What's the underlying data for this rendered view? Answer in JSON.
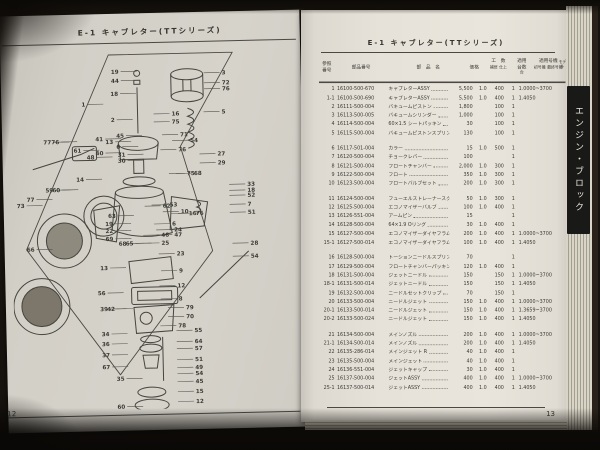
{
  "photo": {
    "background": "#17130e",
    "ink": "#3b3a35",
    "tab_bg": "#191917",
    "tab_fg": "#e9e6dd"
  },
  "left_page": {
    "header": "E-1 キャブレター(TTシリーズ)",
    "page_number": "12",
    "diagram_callouts": [
      {
        "n": "19",
        "x": 110,
        "y": 26
      },
      {
        "n": "44",
        "x": 110,
        "y": 35
      },
      {
        "n": "18",
        "x": 109,
        "y": 48
      },
      {
        "n": "3",
        "x": 213,
        "y": 29
      },
      {
        "n": "72",
        "x": 213,
        "y": 39
      },
      {
        "n": "76",
        "x": 213,
        "y": 45
      },
      {
        "n": "5",
        "x": 212,
        "y": 68
      },
      {
        "n": "1",
        "x": 76,
        "y": 58
      },
      {
        "n": "2",
        "x": 105,
        "y": 74
      },
      {
        "n": "16",
        "x": 162,
        "y": 69
      },
      {
        "n": "75",
        "x": 162,
        "y": 77
      },
      {
        "n": "45",
        "x": 114,
        "y": 90
      },
      {
        "n": "41",
        "x": 93,
        "y": 93
      },
      {
        "n": "13",
        "x": 103,
        "y": 96
      },
      {
        "n": "6",
        "x": 110,
        "y": 101
      },
      {
        "n": "40",
        "x": 93,
        "y": 107
      },
      {
        "n": "54",
        "x": 180,
        "y": 96
      },
      {
        "n": "71",
        "x": 170,
        "y": 90
      },
      {
        "n": "76",
        "x": 168,
        "y": 105
      },
      {
        "n": "31",
        "x": 115,
        "y": 109
      },
      {
        "n": "30",
        "x": 115,
        "y": 115
      },
      {
        "n": "77",
        "x": 41,
        "y": 95
      },
      {
        "n": "76",
        "x": 49,
        "y": 95
      },
      {
        "n": "61",
        "x": 71,
        "y": 104
      },
      {
        "n": "48",
        "x": 84,
        "y": 111
      },
      {
        "n": "27",
        "x": 207,
        "y": 110
      },
      {
        "n": "29",
        "x": 207,
        "y": 119
      },
      {
        "n": "14",
        "x": 73,
        "y": 133
      },
      {
        "n": "59",
        "x": 42,
        "y": 143
      },
      {
        "n": "60",
        "x": 49,
        "y": 143
      },
      {
        "n": "77",
        "x": 23,
        "y": 152
      },
      {
        "n": "73",
        "x": 13,
        "y": 158
      },
      {
        "n": "75",
        "x": 176,
        "y": 129
      },
      {
        "n": "68",
        "x": 183,
        "y": 129
      },
      {
        "n": "33",
        "x": 236,
        "y": 141
      },
      {
        "n": "18",
        "x": 236,
        "y": 147
      },
      {
        "n": "52",
        "x": 236,
        "y": 152
      },
      {
        "n": "7",
        "x": 236,
        "y": 161
      },
      {
        "n": "51",
        "x": 236,
        "y": 169
      },
      {
        "n": "62",
        "x": 151,
        "y": 161
      },
      {
        "n": "53",
        "x": 158,
        "y": 160
      },
      {
        "n": "10",
        "x": 169,
        "y": 167
      },
      {
        "n": "16",
        "x": 177,
        "y": 169
      },
      {
        "n": "76",
        "x": 184,
        "y": 169
      },
      {
        "n": "63",
        "x": 104,
        "y": 170
      },
      {
        "n": "19",
        "x": 101,
        "y": 178
      },
      {
        "n": "22",
        "x": 101,
        "y": 185
      },
      {
        "n": "69",
        "x": 101,
        "y": 193
      },
      {
        "n": "6",
        "x": 160,
        "y": 179
      },
      {
        "n": "24",
        "x": 162,
        "y": 185
      },
      {
        "n": "47",
        "x": 162,
        "y": 190
      },
      {
        "n": "46",
        "x": 149,
        "y": 190
      },
      {
        "n": "25",
        "x": 149,
        "y": 198
      },
      {
        "n": "68",
        "x": 114,
        "y": 198
      },
      {
        "n": "65",
        "x": 121,
        "y": 198
      },
      {
        "n": "23",
        "x": 164,
        "y": 209
      },
      {
        "n": "66",
        "x": 22,
        "y": 202
      },
      {
        "n": "13",
        "x": 95,
        "y": 222
      },
      {
        "n": "9",
        "x": 166,
        "y": 226
      },
      {
        "n": "12",
        "x": 164,
        "y": 241
      },
      {
        "n": "56",
        "x": 92,
        "y": 247
      },
      {
        "n": "39",
        "x": 94,
        "y": 263
      },
      {
        "n": "42",
        "x": 101,
        "y": 263
      },
      {
        "n": "8",
        "x": 165,
        "y": 254
      },
      {
        "n": "79",
        "x": 172,
        "y": 263
      },
      {
        "n": "70",
        "x": 172,
        "y": 272
      },
      {
        "n": "78",
        "x": 164,
        "y": 281
      },
      {
        "n": "28",
        "x": 238,
        "y": 200
      },
      {
        "n": "54",
        "x": 238,
        "y": 213
      },
      {
        "n": "34",
        "x": 95,
        "y": 288
      },
      {
        "n": "55",
        "x": 180,
        "y": 286
      },
      {
        "n": "64",
        "x": 180,
        "y": 297
      },
      {
        "n": "57",
        "x": 180,
        "y": 304
      },
      {
        "n": "36",
        "x": 95,
        "y": 298
      },
      {
        "n": "37",
        "x": 95,
        "y": 309
      },
      {
        "n": "67",
        "x": 95,
        "y": 321
      },
      {
        "n": "51",
        "x": 180,
        "y": 315
      },
      {
        "n": "49",
        "x": 180,
        "y": 323
      },
      {
        "n": "54",
        "x": 180,
        "y": 329
      },
      {
        "n": "35",
        "x": 109,
        "y": 333
      },
      {
        "n": "45",
        "x": 180,
        "y": 337
      },
      {
        "n": "15",
        "x": 180,
        "y": 347
      },
      {
        "n": "12",
        "x": 180,
        "y": 357
      },
      {
        "n": "60",
        "x": 109,
        "y": 361
      }
    ]
  },
  "right_page": {
    "header": "E-1 キャブレター(TTシリーズ)",
    "page_number": "13",
    "side_tab": "エンジン・ブロック",
    "table": {
      "headers": {
        "ref_l1": "参照",
        "ref_l2": "番号",
        "part": "部品番号",
        "name": "部　品　名",
        "price": "価格",
        "labor": "工　数",
        "labor_s1": "補修",
        "labor_s2": "仕上",
        "apply_l1": "適用",
        "apply_l2": "台数",
        "apply_s": "台",
        "serial": "適用号機",
        "serial_s1": "初号機",
        "serial_s2": "最終号機",
        "model": "モデル"
      },
      "rows": [
        {
          "ref": "1",
          "part": "16100-500-670",
          "name": "キャブレターASSY",
          "price": "5,500",
          "labor": "1.0",
          "apply": "400",
          "qty": "1",
          "serial": "1.0000~3700",
          "gap": false
        },
        {
          "ref": "1-1",
          "part": "16100-500-690",
          "name": "キャブレターASSY",
          "price": "5,500",
          "labor": "1.0",
          "apply": "400",
          "qty": "1",
          "serial": "1.4050",
          "gap": false
        },
        {
          "ref": "2",
          "part": "16111-500-004",
          "name": "バキュームピストン",
          "price": "1,800",
          "labor": "",
          "apply": "100",
          "qty": "1",
          "serial": "",
          "gap": false
        },
        {
          "ref": "3",
          "part": "16113-500-005",
          "name": "バキュームシリンダー",
          "price": "1,000",
          "labor": "",
          "apply": "100",
          "qty": "1",
          "serial": "",
          "gap": false
        },
        {
          "ref": "4",
          "part": "16114-500-004",
          "name": "60×1.5 シートパッキン",
          "price": "30",
          "labor": "",
          "apply": "100",
          "qty": "1",
          "serial": "",
          "gap": false
        },
        {
          "ref": "5",
          "part": "16115-500-004",
          "name": "バキュームピストンスプリング",
          "price": "130",
          "labor": "",
          "apply": "100",
          "qty": "1",
          "serial": "",
          "gap": false
        },
        {
          "ref": "6",
          "part": "16117-501-004",
          "name": "カラー",
          "price": "15",
          "labor": "1.0",
          "apply": "500",
          "qty": "1",
          "serial": "",
          "gap": true
        },
        {
          "ref": "7",
          "part": "16120-500-004",
          "name": "チョークレバー",
          "price": "100",
          "labor": "",
          "apply": "",
          "qty": "1",
          "serial": "",
          "gap": false
        },
        {
          "ref": "8",
          "part": "16121-500-004",
          "name": "フロートチャンバー",
          "price": "2,000",
          "labor": "1.0",
          "apply": "300",
          "qty": "1",
          "serial": "",
          "gap": false
        },
        {
          "ref": "9",
          "part": "16122-500-004",
          "name": "フロート",
          "price": "350",
          "labor": "1.0",
          "apply": "300",
          "qty": "1",
          "serial": "",
          "gap": false
        },
        {
          "ref": "10",
          "part": "16123-500-004",
          "name": "フロートバルブセット",
          "price": "200",
          "labor": "1.0",
          "apply": "300",
          "qty": "1",
          "serial": "",
          "gap": false
        },
        {
          "ref": "11",
          "part": "16124-500-004",
          "name": "フューエルストレーナースクリーン",
          "price": "50",
          "labor": "1.0",
          "apply": "300",
          "qty": "1",
          "serial": "",
          "gap": true
        },
        {
          "ref": "12",
          "part": "16125-500-004",
          "name": "エコノマイザーバルブ",
          "price": "100",
          "labor": "1.0",
          "apply": "400",
          "qty": "1",
          "serial": "",
          "gap": false
        },
        {
          "ref": "13",
          "part": "16126-551-004",
          "name": "アームピン",
          "price": "15",
          "labor": "",
          "apply": "",
          "qty": "1",
          "serial": "",
          "gap": false
        },
        {
          "ref": "14",
          "part": "16128-500-004",
          "name": "64×1.9 Oリング",
          "price": "30",
          "labor": "1.0",
          "apply": "400",
          "qty": "1",
          "serial": "",
          "gap": false
        },
        {
          "ref": "15",
          "part": "16127-500-004",
          "name": "エコノマイザーダイヤフラム",
          "price": "200",
          "labor": "1.0",
          "apply": "400",
          "qty": "1",
          "serial": "1.0000~3700",
          "gap": false
        },
        {
          "ref": "15-1",
          "part": "16127-500-014",
          "name": "エコノマイザーダイヤフラム",
          "price": "100",
          "labor": "1.0",
          "apply": "400",
          "qty": "1",
          "serial": "1.4050",
          "gap": false
        },
        {
          "ref": "16",
          "part": "16128-500-004",
          "name": "トーションニードルスプリング",
          "price": "70",
          "labor": "",
          "apply": "",
          "qty": "1",
          "serial": "",
          "gap": true
        },
        {
          "ref": "17",
          "part": "16129-500-004",
          "name": "フロートチャンバーパッキン",
          "price": "120",
          "labor": "1.0",
          "apply": "400",
          "qty": "1",
          "serial": "",
          "gap": false
        },
        {
          "ref": "18",
          "part": "16131-500-004",
          "name": "ジェットニードル",
          "price": "150",
          "labor": "",
          "apply": "150",
          "qty": "1",
          "serial": "1.0000~3700",
          "gap": false
        },
        {
          "ref": "18-1",
          "part": "16131-500-014",
          "name": "ジェットニードル",
          "price": "150",
          "labor": "",
          "apply": "150",
          "qty": "1",
          "serial": "1.4050",
          "gap": false
        },
        {
          "ref": "19",
          "part": "16132-500-004",
          "name": "ニードルセットクリップ",
          "price": "70",
          "labor": "",
          "apply": "150",
          "qty": "1",
          "serial": "",
          "gap": false
        },
        {
          "ref": "20",
          "part": "16133-500-004",
          "name": "ニードルジェット",
          "price": "150",
          "labor": "1.0",
          "apply": "400",
          "qty": "1",
          "serial": "1.0000~3700",
          "gap": false
        },
        {
          "ref": "20-1",
          "part": "16133-500-014",
          "name": "ニードルジェット",
          "price": "150",
          "labor": "1.0",
          "apply": "400",
          "qty": "1",
          "serial": "1.3659~3700",
          "gap": false
        },
        {
          "ref": "20-2",
          "part": "16133-500-024",
          "name": "ニードルジェット",
          "price": "150",
          "labor": "1.0",
          "apply": "400",
          "qty": "1",
          "serial": "1.4050",
          "gap": false
        },
        {
          "ref": "21",
          "part": "16134-500-004",
          "name": "メインノズル",
          "price": "200",
          "labor": "1.0",
          "apply": "400",
          "qty": "1",
          "serial": "1.0000~3700",
          "gap": true
        },
        {
          "ref": "21-1",
          "part": "16134-500-014",
          "name": "メインノズル",
          "price": "200",
          "labor": "1.0",
          "apply": "400",
          "qty": "1",
          "serial": "1.4050",
          "gap": false
        },
        {
          "ref": "22",
          "part": "16135-286-014",
          "name": "メインジェット R",
          "price": "40",
          "labor": "1.0",
          "apply": "400",
          "qty": "1",
          "serial": "",
          "gap": false
        },
        {
          "ref": "23",
          "part": "16135-500-004",
          "name": "メインジェット",
          "price": "40",
          "labor": "1.0",
          "apply": "400",
          "qty": "1",
          "serial": "",
          "gap": false
        },
        {
          "ref": "24",
          "part": "16136-551-004",
          "name": "ジェットキャップ",
          "price": "30",
          "labor": "1.0",
          "apply": "400",
          "qty": "1",
          "serial": "",
          "gap": false
        },
        {
          "ref": "25",
          "part": "16137-500-004",
          "name": "ジェットASSY",
          "price": "400",
          "labor": "1.0",
          "apply": "400",
          "qty": "1",
          "serial": "1.0000~3700",
          "gap": false
        },
        {
          "ref": "25-1",
          "part": "16137-500-014",
          "name": "ジェットASSY",
          "price": "400",
          "labor": "1.0",
          "apply": "400",
          "qty": "1",
          "serial": "1.4050",
          "gap": false
        }
      ]
    }
  }
}
